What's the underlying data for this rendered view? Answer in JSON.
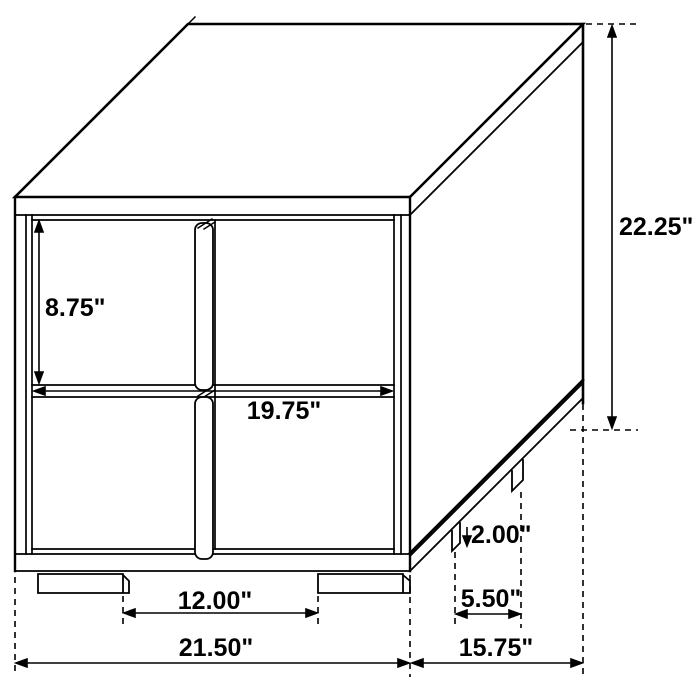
{
  "drawing": {
    "title": "2-drawer nightstand dimension diagram",
    "colors": {
      "line": "#000000",
      "background": "#ffffff"
    },
    "dimensions": {
      "drawer_front_height": "8.75\"",
      "overall_height": "22.25\"",
      "opening_width": "19.75\"",
      "leg_height": "2.00\"",
      "side_leg_spacing": "5.50\"",
      "overall_depth": "15.75\"",
      "front_leg_spacing": "12.00\"",
      "overall_width": "21.50\""
    }
  }
}
